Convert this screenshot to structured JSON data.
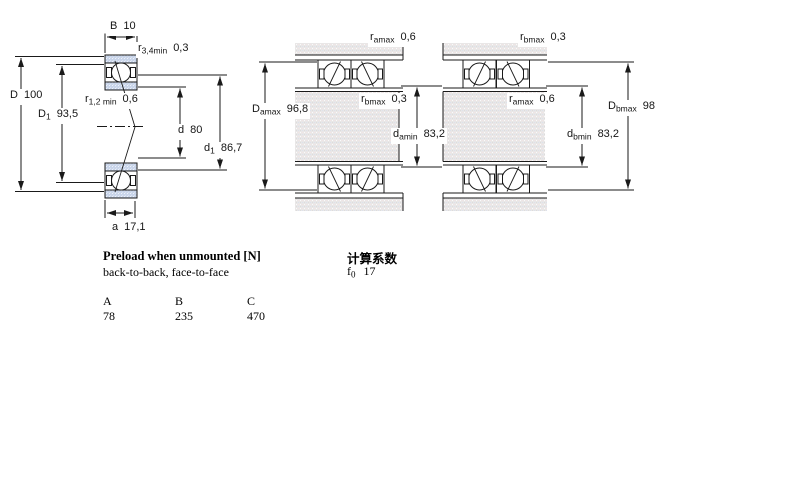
{
  "page": {
    "background": "#ffffff"
  },
  "drawing_colors": {
    "line": "#1a1a1a",
    "ring_fill": "#c9d5ea",
    "metal_fill": "#e9e7e7",
    "ball_fill": "#ffffff"
  },
  "dimension_labels": {
    "left_view": {
      "B": {
        "sym": "B",
        "sub": "",
        "val": "10"
      },
      "r34": {
        "sym": "r",
        "sub": "3,4min",
        "val": "0,3"
      },
      "D": {
        "sym": "D",
        "sub": "",
        "val": "100"
      },
      "D1": {
        "sym": "D",
        "sub": "1",
        "val": "93,5"
      },
      "r12": {
        "sym": "r",
        "sub": "1,2 min",
        "val": "0,6"
      },
      "d": {
        "sym": "d",
        "sub": "",
        "val": "80"
      },
      "d1": {
        "sym": "d",
        "sub": "1",
        "val": "86,7"
      },
      "a": {
        "sym": "a",
        "sub": "",
        "val": "17,1"
      }
    },
    "middle_view": {
      "ramax": {
        "sym": "r",
        "sub": "amax",
        "val": "0,6"
      },
      "Damax": {
        "sym": "D",
        "sub": "amax",
        "val": "96,8"
      },
      "rbmax": {
        "sym": "r",
        "sub": "bmax",
        "val": "0,3"
      },
      "damin": {
        "sym": "d",
        "sub": "amin",
        "val": "83,2"
      }
    },
    "right_view": {
      "rbmax": {
        "sym": "r",
        "sub": "bmax",
        "val": "0,3"
      },
      "ramax": {
        "sym": "r",
        "sub": "amax",
        "val": "0,6"
      },
      "Dbmax": {
        "sym": "D",
        "sub": "bmax",
        "val": "98"
      },
      "dbmin": {
        "sym": "d",
        "sub": "bmin",
        "val": "83,2"
      }
    }
  },
  "preload": {
    "title": "Preload when unmounted [N]",
    "subtitle": "back-to-back, face-to-face",
    "table": {
      "headers": [
        "A",
        "B",
        "C"
      ],
      "values": [
        "78",
        "235",
        "470"
      ]
    }
  },
  "calculation": {
    "title": "计算系数",
    "factor": {
      "sym": "f",
      "sub": "0",
      "val": "17"
    }
  }
}
